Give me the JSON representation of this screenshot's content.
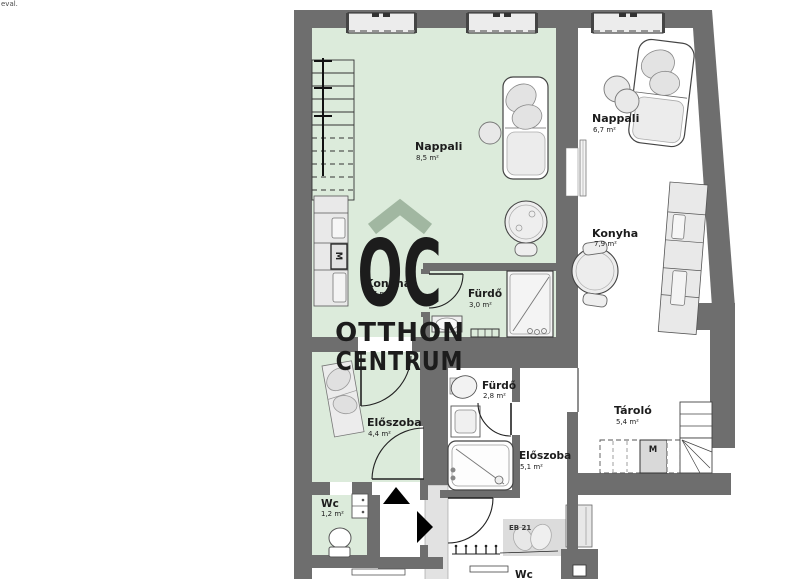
{
  "page": {
    "corner_text": "eval.",
    "background": "#ffffff"
  },
  "plan": {
    "wall_color": "#6e6e6e",
    "floor_green": "#dcebdb",
    "floor_white": "#ffffff",
    "furniture_fill": "#ececec",
    "line_color": "#2a2a2a",
    "accent_black": "#000000"
  },
  "watermark": {
    "initials": "OC",
    "line1": "OTTHON",
    "line2": "CENTRUM",
    "color": "rgba(152,175,152,0.88)"
  },
  "rooms": [
    {
      "id": "nappali-1",
      "name": "Nappali",
      "area": "8,5 m²"
    },
    {
      "id": "konyha-1",
      "name": "Konyha",
      "area": "6,7 m²"
    },
    {
      "id": "furdo-1",
      "name": "Fürdő",
      "area": "3,0 m²"
    },
    {
      "id": "eloszoba-1",
      "name": "Előszoba",
      "area": "4,4 m²"
    },
    {
      "id": "wc-1",
      "name": "Wc",
      "area": "1,2 m²"
    },
    {
      "id": "nappali-2",
      "name": "Nappali",
      "area": "6,7 m²"
    },
    {
      "id": "konyha-2",
      "name": "Konyha",
      "area": "7,9 m²"
    },
    {
      "id": "furdo-2",
      "name": "Fürdő",
      "area": "2,8 m²"
    },
    {
      "id": "eloszoba-2",
      "name": "Előszoba",
      "area": "5,1 m²"
    },
    {
      "id": "tarolo",
      "name": "Tároló",
      "area": "5,4 m²"
    },
    {
      "id": "wc-2",
      "name": "Wc",
      "area": ""
    }
  ],
  "labels": {
    "eb21": "EB 21",
    "counter_m": "M",
    "shelf_m": "M"
  }
}
